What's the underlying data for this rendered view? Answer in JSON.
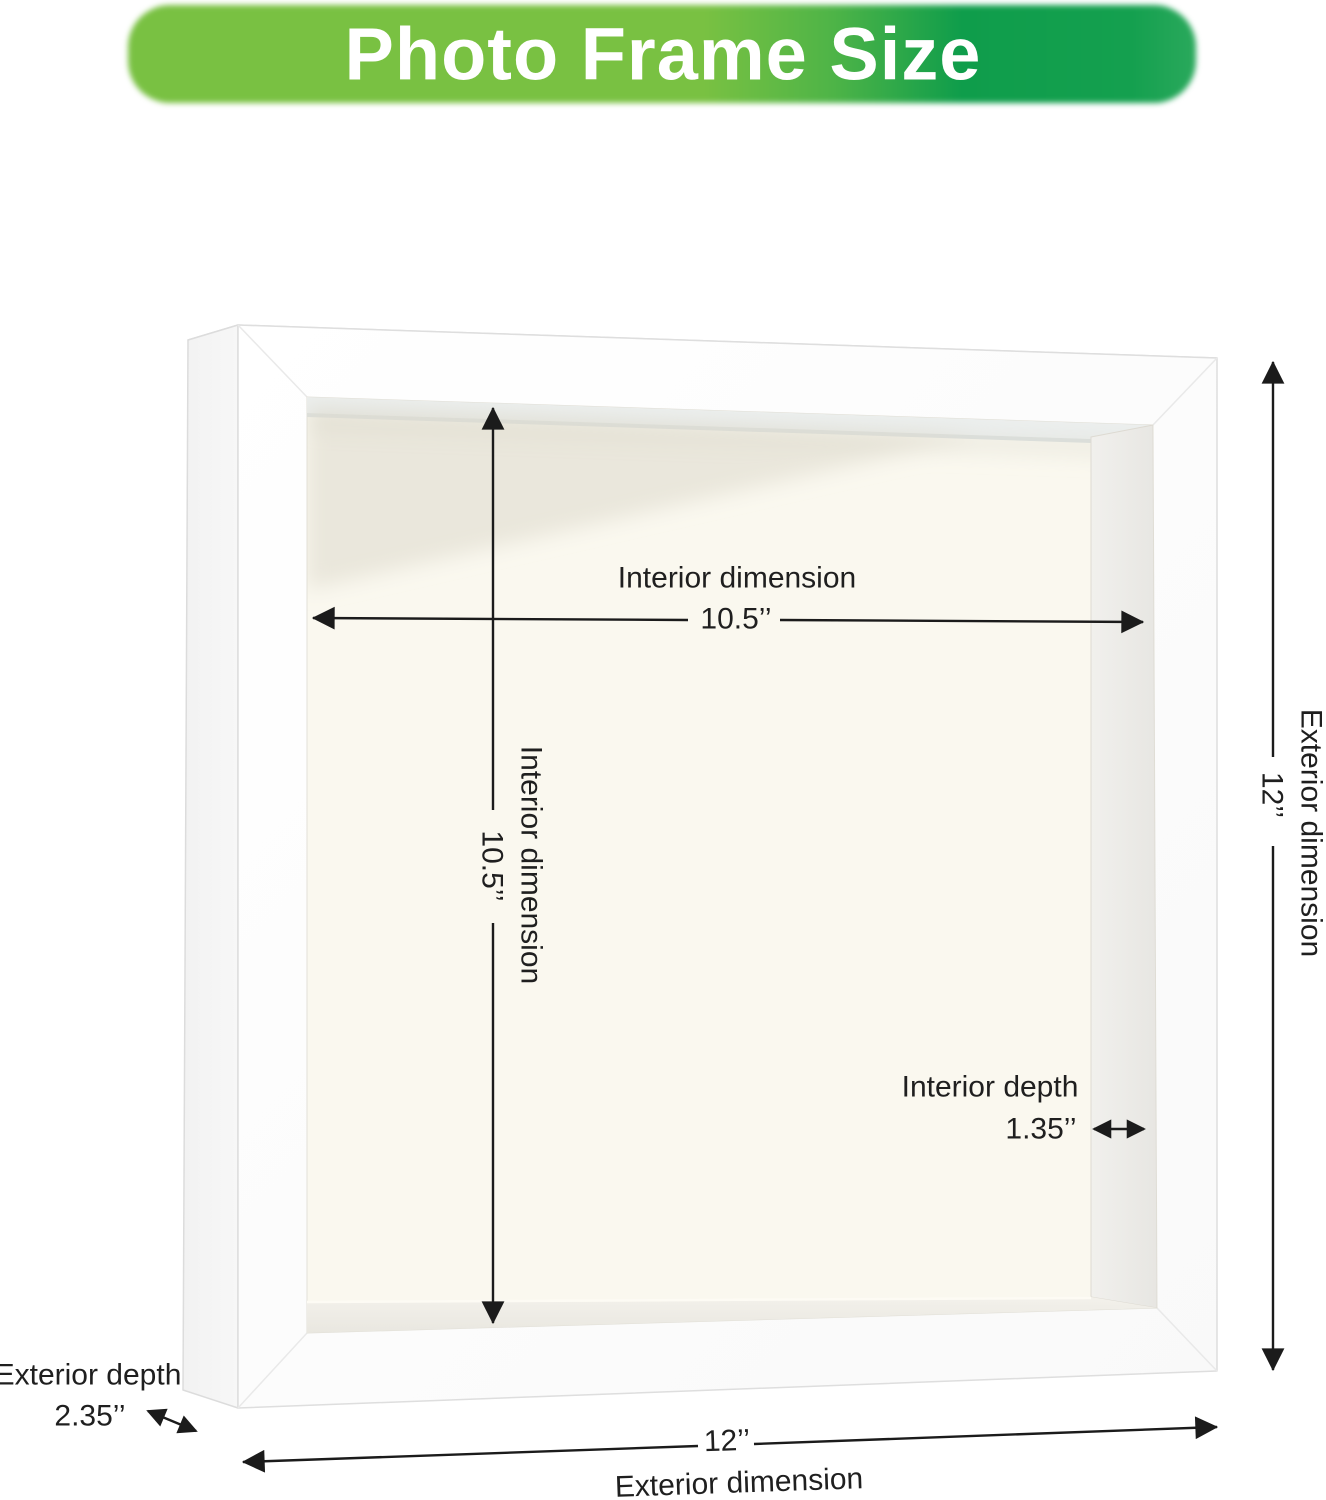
{
  "banner": {
    "title": "Photo Frame Size",
    "color_left": "#79C142",
    "color_right": "#0F9D4B",
    "text_color": "#FFFFFF"
  },
  "dimensions": {
    "interior_width": {
      "label": "Interior dimension",
      "value": "10.5’’"
    },
    "interior_height": {
      "label": "Interior dimension",
      "value": "10.5’’"
    },
    "interior_depth": {
      "label": "Interior depth",
      "value": "1.35’’"
    },
    "exterior_height": {
      "label": "Exterior dimension",
      "value": "12’’"
    },
    "exterior_width": {
      "label": "Exterior dimension",
      "value": "12’’"
    },
    "exterior_depth": {
      "label": "Exterior depth",
      "value": "2.35’’"
    }
  },
  "frame": {
    "front_color": "#FDFDFD",
    "back_panel_color": "#FAF8EF",
    "dimension_line_color": "#1B1B1B"
  }
}
